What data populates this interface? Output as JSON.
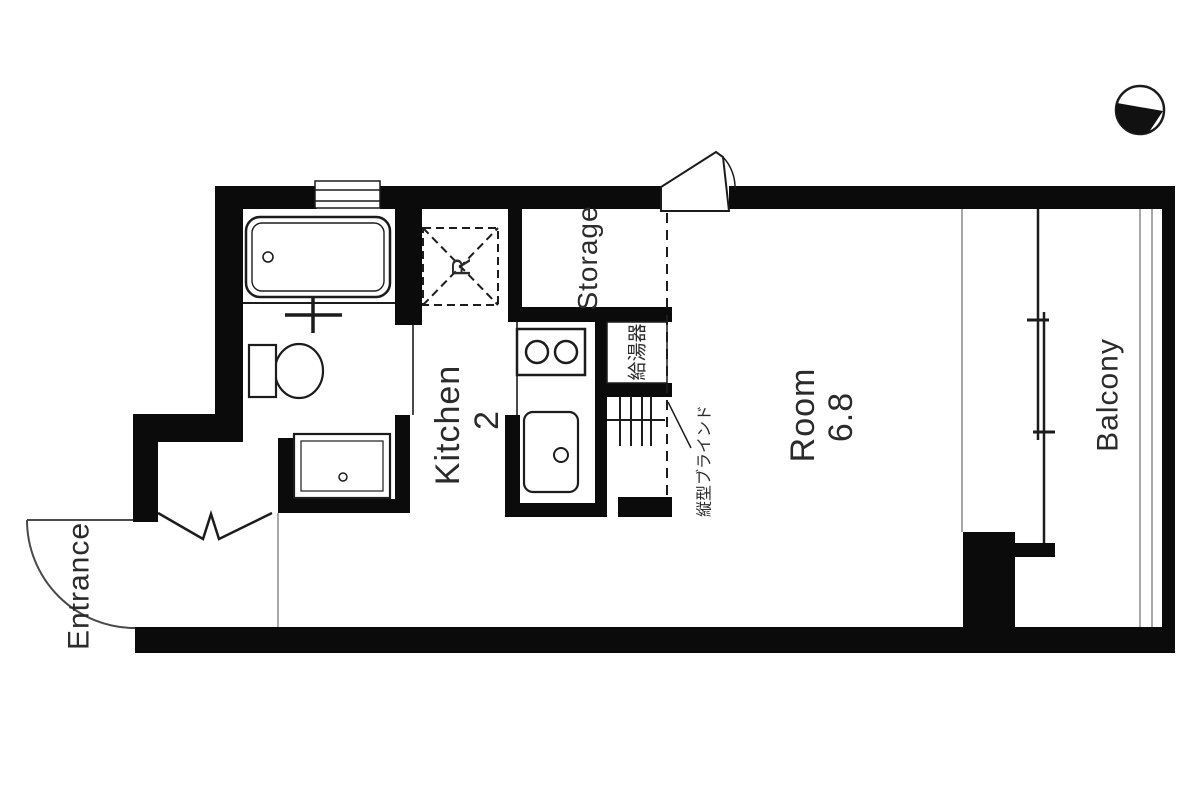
{
  "title": "Studio apartment floor plan",
  "colors": {
    "background": "#ffffff",
    "wall": "#0b0b0b",
    "line": "#1c1c1c",
    "thin_line": "#8c8c8c",
    "text": "#2b2b2b"
  },
  "labels": {
    "entrance": "Entrance",
    "kitchen": "Kitchen",
    "kitchen_size": "2",
    "storage": "Storage",
    "refrigerator": "R",
    "water_heater": "給湯器",
    "vertical_blind": "縦型ブラインド",
    "room": "Room",
    "room_size": "6.8",
    "balcony": "Balcony"
  },
  "fixtures": [
    "north-arrow-icon",
    "bathtub-icon",
    "bath-door-cross-icon",
    "toilet-icon",
    "washbasin-icon",
    "bifold-closet-door-icon",
    "entrance-door-swing-icon",
    "refrigerator-space-dashed-box",
    "stove-two-burner-icon",
    "kitchen-sink-icon",
    "water-heater-box",
    "shelf-lines-icon",
    "vertical-blind-dashed-line",
    "awning-window-icon",
    "bath-window-icon",
    "sliding-window-icon",
    "balcony-railing"
  ]
}
